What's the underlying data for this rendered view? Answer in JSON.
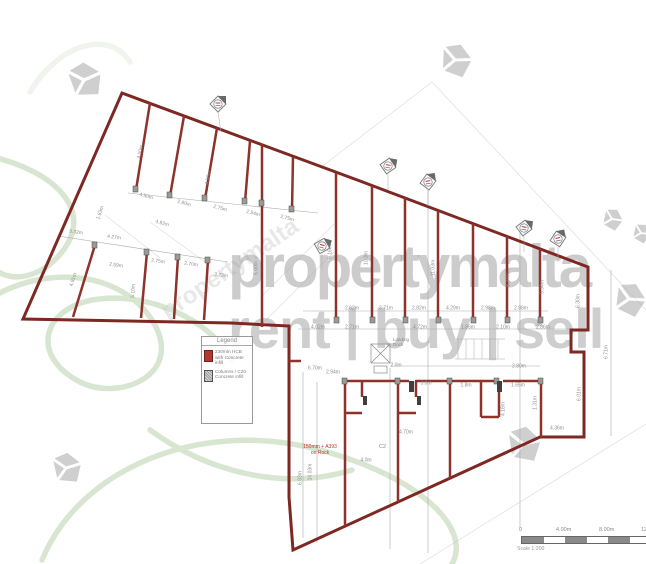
{
  "watermark": {
    "brand": "propertymalta",
    "tagline": "rent | buy | sell"
  },
  "legend": {
    "title": "Legend",
    "items": [
      {
        "swatch": "red-fill",
        "label": "230mm HCB with Concrete infill"
      },
      {
        "swatch": "gray-hatch",
        "label": "Columns / C20 Concrete infill"
      }
    ]
  },
  "scale_bar": {
    "ticks": [
      "0",
      "4.00m",
      "8.00m",
      "12.00m"
    ],
    "caption": "Scale 1:200"
  },
  "annotations": {
    "slab_note_line1": "150mm + A393",
    "slab_note_line2": "on Rock",
    "column_ref": "C2",
    "loading_dock": "Loading Dock"
  },
  "colors": {
    "wall_red": "#8e332c",
    "outline_red": "#7e2823",
    "legend_red": "#b03a2e",
    "note_red": "#c0392b",
    "column_gray": "#9b9b94",
    "dimension_gray": "#8f8f8f",
    "watermark_gray": "#9e9e9e",
    "logo_green": "#b9d2ab"
  },
  "plan": {
    "dim_labels": [
      {
        "t": "4.50m",
        "x": 146,
        "y": 197,
        "r": 16
      },
      {
        "t": "2.80m",
        "x": 184,
        "y": 204,
        "r": 16
      },
      {
        "t": "2.75m",
        "x": 220,
        "y": 209,
        "r": 16
      },
      {
        "t": "2.54m",
        "x": 253,
        "y": 214,
        "r": 16
      },
      {
        "t": "2.75m",
        "x": 287,
        "y": 219,
        "r": 16
      },
      {
        "t": "4.92m",
        "x": 162,
        "y": 224,
        "r": 16
      },
      {
        "t": "4.50m",
        "x": 141,
        "y": 152,
        "r": -78
      },
      {
        "t": "4.56m",
        "x": 209,
        "y": 178,
        "r": -78
      },
      {
        "t": "1.83m",
        "x": 101,
        "y": 213,
        "r": -70
      },
      {
        "t": "3.32m",
        "x": 76,
        "y": 233,
        "r": 8
      },
      {
        "t": "4.27m",
        "x": 114,
        "y": 238,
        "r": 8
      },
      {
        "t": "2.59m",
        "x": 116,
        "y": 266,
        "r": 8
      },
      {
        "t": "2.75m",
        "x": 158,
        "y": 262,
        "r": 8
      },
      {
        "t": "2.70m",
        "x": 191,
        "y": 265,
        "r": 8
      },
      {
        "t": "3.23m",
        "x": 221,
        "y": 276,
        "r": 8
      },
      {
        "t": "5.10m",
        "x": 134,
        "y": 291,
        "r": -86
      },
      {
        "t": "4.91m",
        "x": 74,
        "y": 280,
        "r": -72
      },
      {
        "t": "2.62m",
        "x": 352,
        "y": 309,
        "r": 0
      },
      {
        "t": "2.71m",
        "x": 386,
        "y": 309,
        "r": 0
      },
      {
        "t": "2.82m",
        "x": 419,
        "y": 309,
        "r": 0
      },
      {
        "t": "4.29m",
        "x": 453,
        "y": 309,
        "r": 0
      },
      {
        "t": "2.98m",
        "x": 488,
        "y": 309,
        "r": 0
      },
      {
        "t": "2.88m",
        "x": 521,
        "y": 309,
        "r": 0
      },
      {
        "t": "4.02m",
        "x": 318,
        "y": 328,
        "r": 0
      },
      {
        "t": "2.71m",
        "x": 352,
        "y": 328,
        "r": 0
      },
      {
        "t": "4.72m",
        "x": 420,
        "y": 328,
        "r": 0
      },
      {
        "t": "1.86m",
        "x": 468,
        "y": 328,
        "r": 0
      },
      {
        "t": "2.10m",
        "x": 503,
        "y": 328,
        "r": 0
      },
      {
        "t": "2.86m",
        "x": 543,
        "y": 328,
        "r": 0
      },
      {
        "t": "9.16m",
        "x": 331,
        "y": 252,
        "r": -90
      },
      {
        "t": "10.3m",
        "x": 367,
        "y": 258,
        "r": -90
      },
      {
        "t": "11.03m",
        "x": 434,
        "y": 268,
        "r": -90
      },
      {
        "t": "8.34m",
        "x": 509,
        "y": 280,
        "r": -90
      },
      {
        "t": "5.34m",
        "x": 543,
        "y": 287,
        "r": -90
      },
      {
        "t": "6.30m",
        "x": 579,
        "y": 301,
        "r": -90
      },
      {
        "t": "5.00m",
        "x": 257,
        "y": 268,
        "r": -90
      },
      {
        "t": "6.71m",
        "x": 607,
        "y": 352,
        "r": -90
      },
      {
        "t": "6.01m",
        "x": 580,
        "y": 394,
        "r": -90
      },
      {
        "t": "2.0m",
        "x": 396,
        "y": 366,
        "r": 0
      },
      {
        "t": "3.0m",
        "x": 426,
        "y": 384,
        "r": 0
      },
      {
        "t": "1.8m",
        "x": 466,
        "y": 386,
        "r": 0
      },
      {
        "t": "1.65m",
        "x": 518,
        "y": 386,
        "r": 0
      },
      {
        "t": "2.80m",
        "x": 519,
        "y": 367,
        "r": 0
      },
      {
        "t": "4.70m",
        "x": 406,
        "y": 433,
        "r": 0
      },
      {
        "t": "4.0m",
        "x": 366,
        "y": 461,
        "r": 0
      },
      {
        "t": "6.70m",
        "x": 315,
        "y": 369,
        "r": 0
      },
      {
        "t": "4.36m",
        "x": 557,
        "y": 429,
        "r": 0
      },
      {
        "t": "1.31m",
        "x": 536,
        "y": 403,
        "r": -90
      },
      {
        "t": "14.03m",
        "x": 311,
        "y": 472,
        "r": -90
      },
      {
        "t": "6.93m",
        "x": 301,
        "y": 478,
        "r": -90
      },
      {
        "t": "4.18m",
        "x": 504,
        "y": 409,
        "r": -90
      },
      {
        "t": "2.94m",
        "x": 333,
        "y": 373,
        "r": 0
      }
    ]
  }
}
